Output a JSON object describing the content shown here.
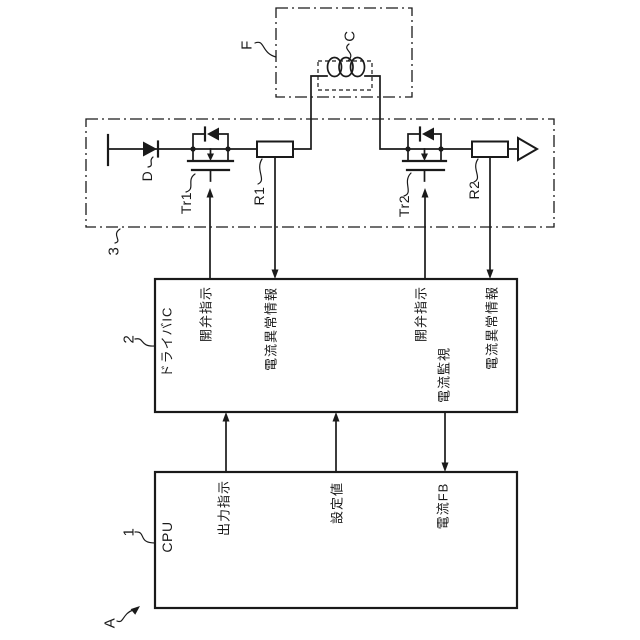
{
  "colors": {
    "background": "#ffffff",
    "ink": "#1a1a1a"
  },
  "refs": {
    "system": "A",
    "cpu": "1",
    "driver_ic": "2",
    "drive_circuit": "3",
    "injector": "F",
    "coil": "C",
    "diode": "D",
    "transistor1": "Tr1",
    "resistor1": "R1",
    "transistor2": "Tr2",
    "resistor2": "R2"
  },
  "cpu": {
    "title": "CPU",
    "signals": {
      "output_instruction": "出力指示",
      "set_value": "設定値",
      "current_fb": "電流FB"
    }
  },
  "driver": {
    "title": "ドライバIC",
    "signals": {
      "valve_open_1": "開弁指示",
      "current_abnormality_1": "電流異常情報",
      "valve_open_2": "開弁指示",
      "current_monitoring": "電流監視",
      "current_abnormality_2": "電流異常情報"
    }
  }
}
